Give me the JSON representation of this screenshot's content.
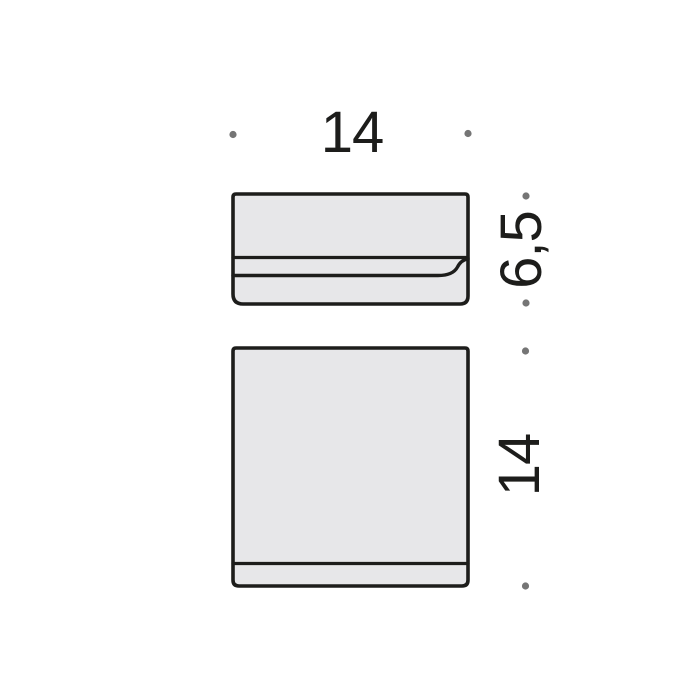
{
  "diagram": {
    "type": "technical-dimension-drawing",
    "labels": {
      "width": "14",
      "side_height": "6,5",
      "front_height": "14"
    },
    "views": {
      "side_view": "side profile of wall-mounted holder with mounting plate and lip",
      "front_view": "front square face with base strip"
    },
    "colors": {
      "outline": "#1d1d1b",
      "fill": "#e7e7e9",
      "marker_dot": "#757575",
      "background": "#ffffff",
      "text": "#1d1d1b"
    },
    "marker_count": 6
  }
}
